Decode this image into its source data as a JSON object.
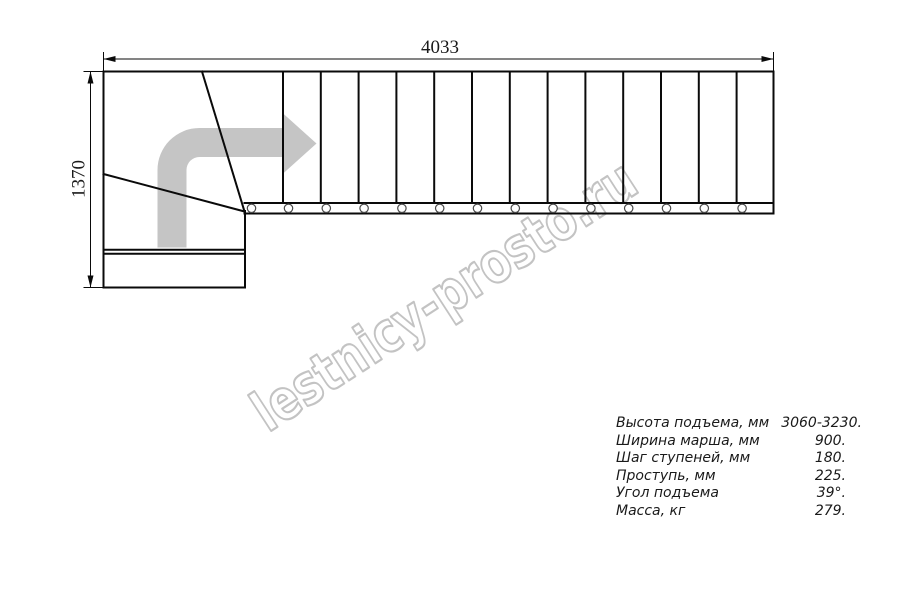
{
  "watermark": {
    "text": "lestnicy-prosto.ru"
  },
  "dimensions": {
    "width": "4033",
    "height": "1370"
  },
  "specs": {
    "rows": [
      {
        "label": "Высота подъема, мм",
        "value": "3060-3230."
      },
      {
        "label": "Ширина марша, мм",
        "value": "900."
      },
      {
        "label": "Шаг ступеней, мм",
        "value": "180."
      },
      {
        "label": "Проступь, мм",
        "value": "225."
      },
      {
        "label": "Угол подъема",
        "value": "39°."
      },
      {
        "label": "Масса, кг",
        "value": "279."
      }
    ]
  },
  "colors": {
    "line": "#0a0a0a",
    "arrow": "#c5c5c5",
    "watermark": "#c3c3c3",
    "ink": "#1a1a1a"
  }
}
